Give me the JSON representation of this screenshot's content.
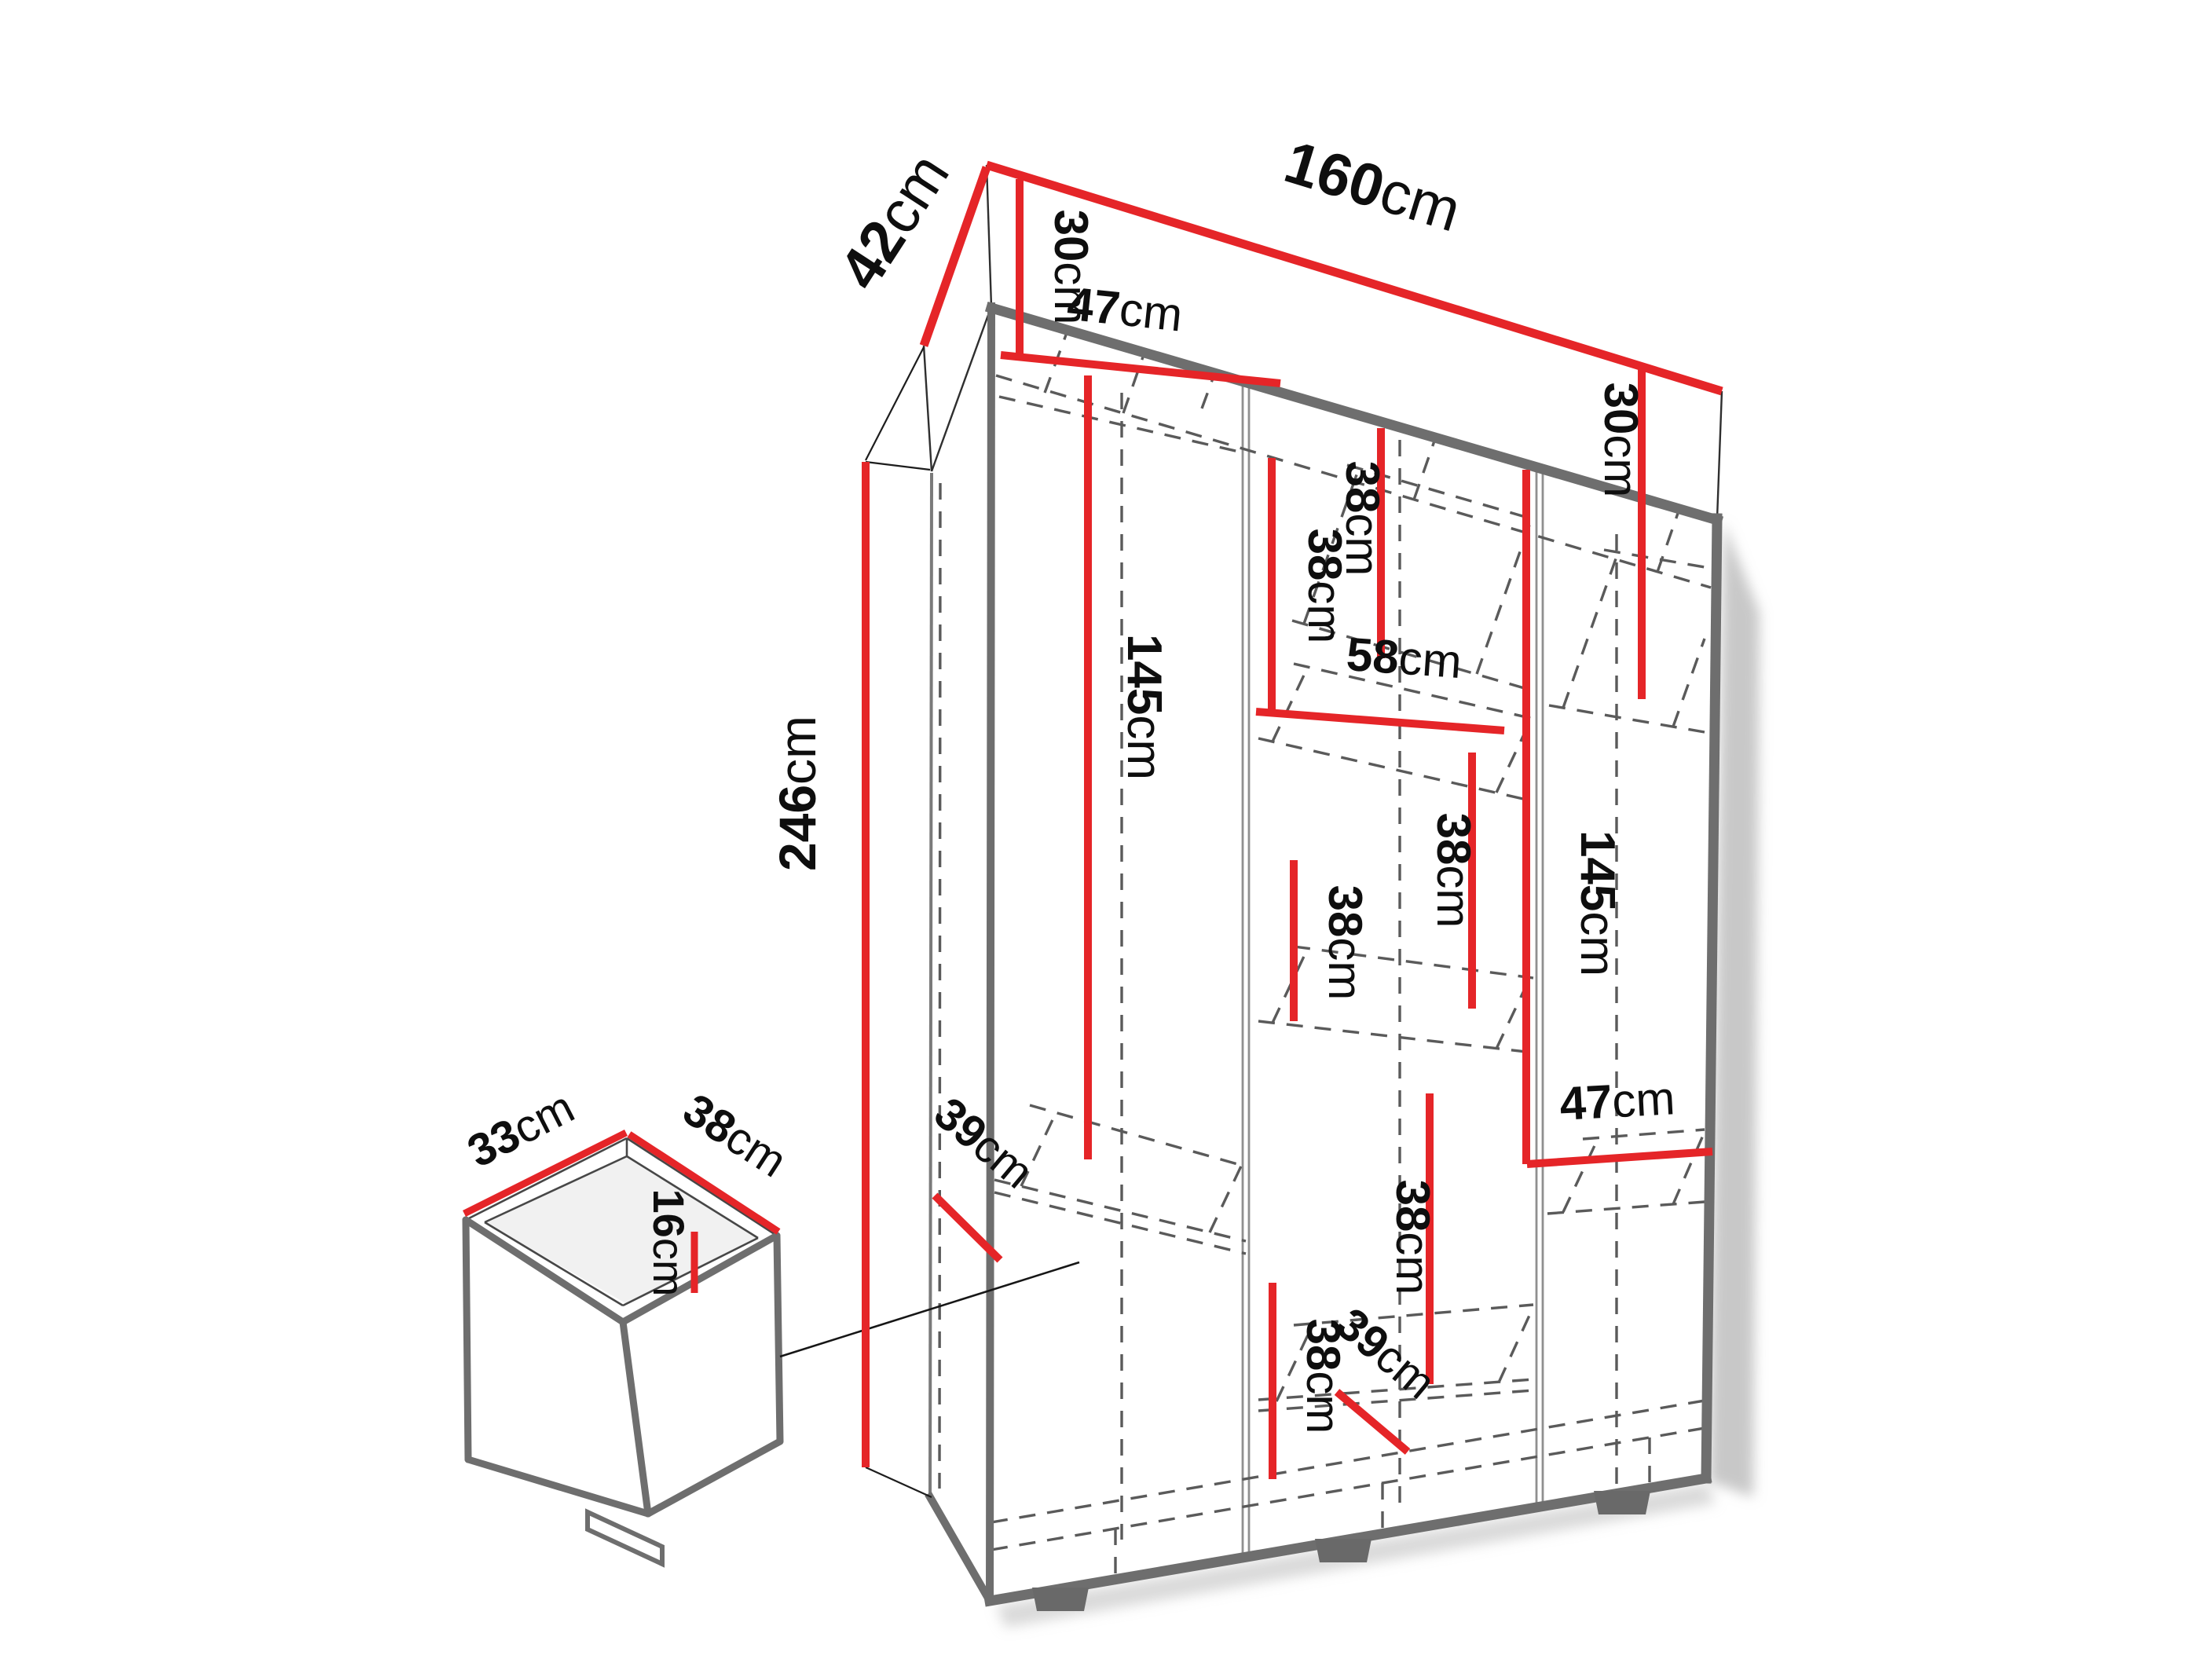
{
  "page": {
    "background": "#ffffff"
  },
  "colors": {
    "dimension_red": "#e52528",
    "edge_gray": "#6e6e6e",
    "dash_gray": "#5a5a5a",
    "text": "#0e0e0e"
  },
  "wardrobe": {
    "overall": {
      "width": {
        "value": "160",
        "unit": "cm"
      },
      "depth": {
        "value": "42",
        "unit": "cm"
      },
      "height": {
        "value": "246",
        "unit": "cm"
      }
    },
    "left_section": {
      "top_gap": {
        "value": "30",
        "unit": "cm"
      },
      "shelf_width": {
        "value": "47",
        "unit": "cm"
      },
      "hanging_height": {
        "value": "145",
        "unit": "cm"
      },
      "shelf_depth": {
        "value": "39",
        "unit": "cm"
      }
    },
    "middle_section": {
      "gap_1": {
        "value": "38",
        "unit": "cm"
      },
      "gap_2": {
        "value": "38",
        "unit": "cm"
      },
      "shelf_width": {
        "value": "58",
        "unit": "cm"
      },
      "gap_3": {
        "value": "38",
        "unit": "cm"
      },
      "gap_4": {
        "value": "38",
        "unit": "cm"
      },
      "gap_5": {
        "value": "38",
        "unit": "cm"
      },
      "gap_6": {
        "value": "38",
        "unit": "cm"
      },
      "shelf_depth": {
        "value": "39",
        "unit": "cm"
      }
    },
    "right_section": {
      "top_gap": {
        "value": "30",
        "unit": "cm"
      },
      "hanging_height": {
        "value": "145",
        "unit": "cm"
      },
      "shelf_width": {
        "value": "47",
        "unit": "cm"
      }
    },
    "drawer": {
      "width": {
        "value": "33",
        "unit": "cm"
      },
      "depth": {
        "value": "38",
        "unit": "cm"
      },
      "height": {
        "value": "16",
        "unit": "cm"
      }
    }
  }
}
